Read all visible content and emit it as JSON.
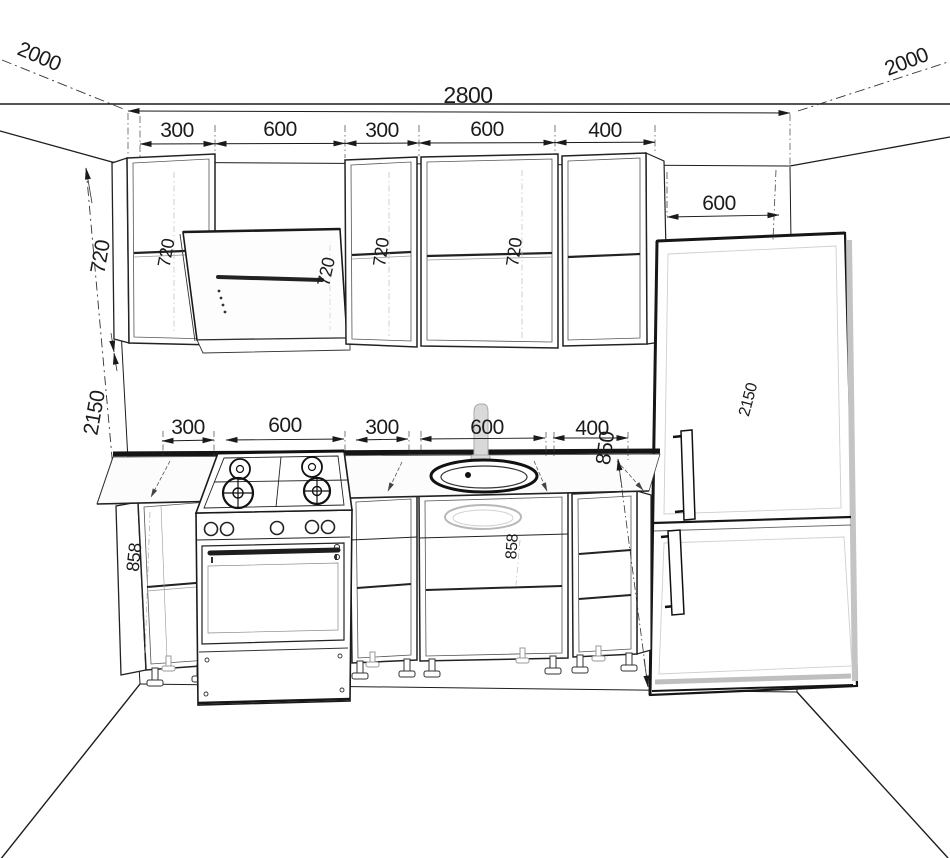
{
  "drawing": {
    "kind": "kitchen-elevation-wireframe",
    "background": "#ffffff",
    "line_color": "#1b1b1b",
    "ghost_color": "#c6c6c6"
  },
  "dimensions": {
    "overall_width": "2800",
    "left_wall_depth": "2000",
    "right_wall_depth": "2000",
    "upper_row": [
      "300",
      "600",
      "300",
      "600",
      "400"
    ],
    "base_row": [
      "300",
      "600",
      "300",
      "600",
      "400"
    ],
    "upper_cabinet_height": "720",
    "total_height": "2150",
    "worktop_height": "850",
    "base_cabinet_height": "858",
    "fridge_clearance": "600"
  },
  "ghost_labels": {
    "upper_cab_left": "720",
    "hood": "720",
    "upper_cab_mid": "720",
    "upper_cab_wide": "720",
    "sink_cab": "858",
    "fridge": "2150"
  }
}
